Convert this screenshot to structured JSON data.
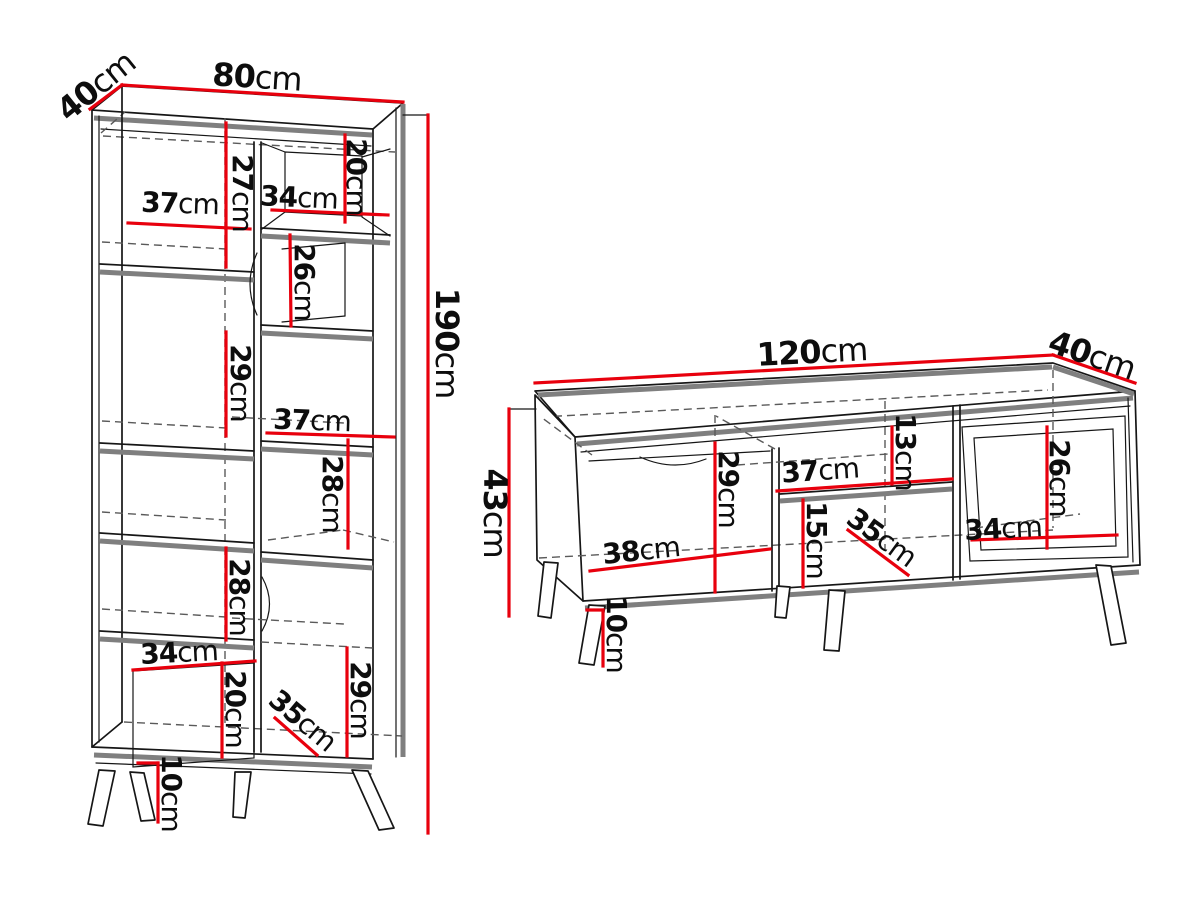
{
  "diagram_title": "furniture-dimension-diagram",
  "colors": {
    "dimension_red": "#e8000d",
    "outline_black": "#161616",
    "panel_gray": "#7f7f7f",
    "hidden_dash_gray": "#5a5a5a",
    "label_black": "#0d0d0d",
    "background": "#ffffff"
  },
  "bookcase": {
    "name": "bookcase",
    "labels": {
      "depth40": {
        "v": "40",
        "u": "cm"
      },
      "width80": {
        "v": "80",
        "u": "cm"
      },
      "height190": {
        "v": "190",
        "u": "cm"
      },
      "top_left_height27": {
        "v": "27",
        "u": "cm"
      },
      "top_left_width37": {
        "v": "37",
        "u": "cm"
      },
      "top_right_width34": {
        "v": "34",
        "u": "cm"
      },
      "top_right_height20": {
        "v": "20",
        "u": "cm"
      },
      "upper_right_height26": {
        "v": "26",
        "u": "cm"
      },
      "mid_left_height29": {
        "v": "29",
        "u": "cm"
      },
      "mid_right_width37": {
        "v": "37",
        "u": "cm"
      },
      "mid_right_height28": {
        "v": "28",
        "u": "cm"
      },
      "lower_left_height28": {
        "v": "28",
        "u": "cm"
      },
      "bottom_left_width34": {
        "v": "34",
        "u": "cm"
      },
      "bottom_left_height20": {
        "v": "20",
        "u": "cm"
      },
      "bottom_door_width35": {
        "v": "35",
        "u": "cm"
      },
      "bottom_right_height29": {
        "v": "29",
        "u": "cm"
      },
      "leg_height10": {
        "v": "10",
        "u": "cm"
      }
    }
  },
  "tv_stand": {
    "name": "tv-stand",
    "labels": {
      "width120": {
        "v": "120",
        "u": "cm"
      },
      "depth40": {
        "v": "40",
        "u": "cm"
      },
      "height43": {
        "v": "43",
        "u": "cm"
      },
      "left_section_height29": {
        "v": "29",
        "u": "cm"
      },
      "mid_shelf_width37": {
        "v": "37",
        "u": "cm"
      },
      "mid_top_height13": {
        "v": "13",
        "u": "cm"
      },
      "mid_bottom_height15": {
        "v": "15",
        "u": "cm"
      },
      "mid_door_width35": {
        "v": "35",
        "u": "cm"
      },
      "right_section_height26": {
        "v": "26",
        "u": "cm"
      },
      "right_section_width34": {
        "v": "34",
        "u": "cm"
      },
      "left_door_width38": {
        "v": "38",
        "u": "cm"
      },
      "leg_height10": {
        "v": "10",
        "u": "cm"
      }
    }
  }
}
